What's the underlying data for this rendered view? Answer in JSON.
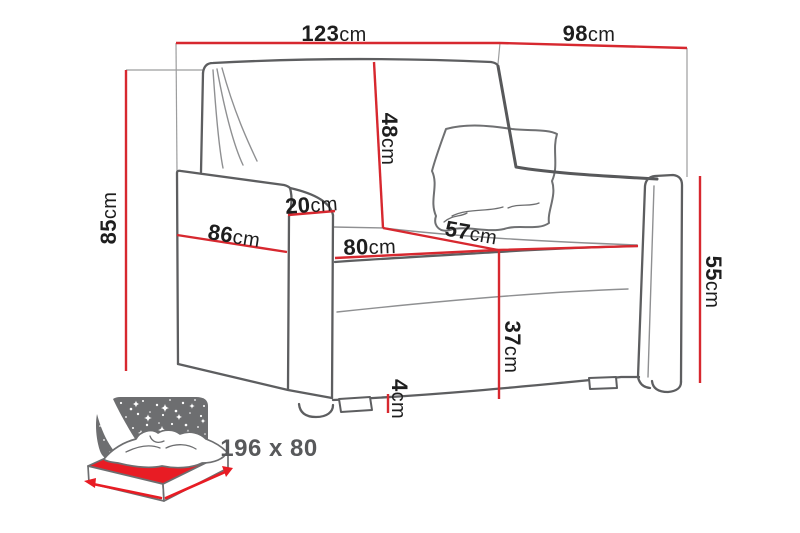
{
  "dims": {
    "total_width": {
      "value": "123",
      "unit": "cm"
    },
    "total_depth": {
      "value": "98",
      "unit": "cm"
    },
    "total_height": {
      "value": "85",
      "unit": "cm"
    },
    "backrest_height": {
      "value": "48",
      "unit": "cm"
    },
    "armrest_width": {
      "value": "20",
      "unit": "cm"
    },
    "side_depth": {
      "value": "86",
      "unit": "cm"
    },
    "seat_width": {
      "value": "80",
      "unit": "cm"
    },
    "seat_depth": {
      "value": "57",
      "unit": "cm"
    },
    "seat_height": {
      "value": "37",
      "unit": "cm"
    },
    "leg_height": {
      "value": "4",
      "unit": "cm"
    },
    "armrest_height": {
      "value": "55",
      "unit": "cm"
    }
  },
  "sleeping_area": {
    "label": "196 x 80"
  },
  "icons": {
    "sofa_bed_icon": "sofa-bed-night-icon"
  },
  "colors": {
    "dimension_line_red": "#d7282f",
    "sofa_outline_gray": "#5d5e60",
    "construction_gray": "#9c9d9e",
    "icon_gray": "#6d6e70",
    "icon_red": "#e81c24",
    "label_text": "#1e1e1e",
    "sleeping_label_text": "#58595b",
    "background": "#ffffff"
  }
}
